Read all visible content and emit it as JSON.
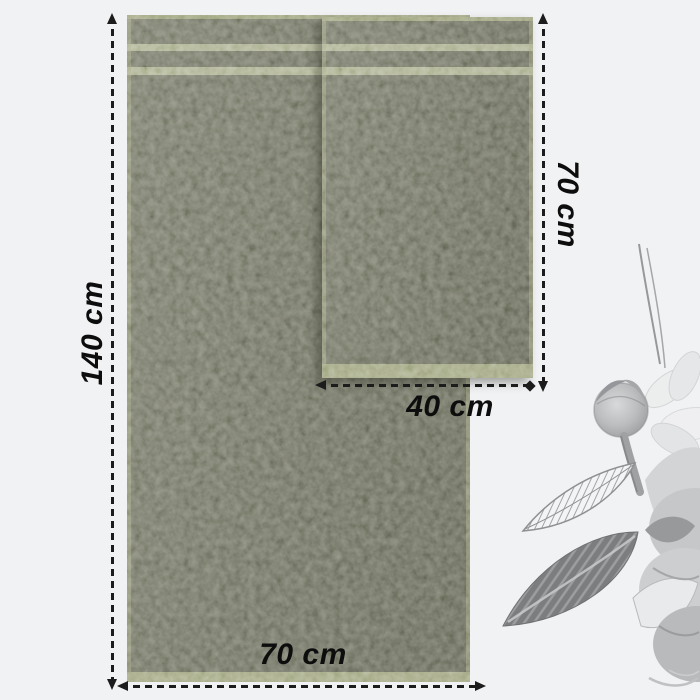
{
  "diagram": {
    "kind": "towel-size-diagram",
    "background_color": "#f1f2f4",
    "annotation_color": "#1c1c1c",
    "towel_colors": {
      "body": "#6f715f",
      "stripe": "#b4b897",
      "hem": "#9ea37e"
    },
    "towels": {
      "large": {
        "height_label": "140 cm",
        "width_label": "70 cm"
      },
      "small": {
        "height_label": "70 cm",
        "width_label": "40 cm"
      }
    },
    "decoration": {
      "name": "grayscale-watercolor-flower"
    }
  }
}
